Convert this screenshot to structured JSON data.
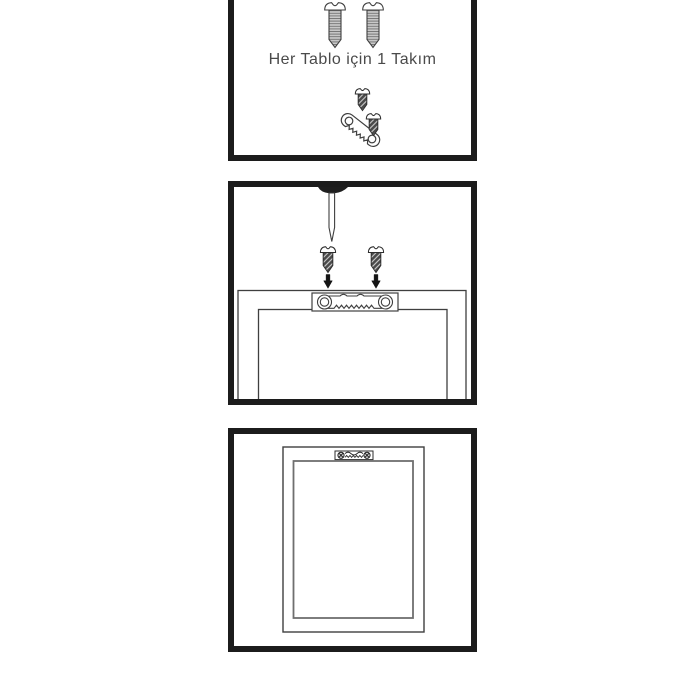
{
  "sheet": {
    "type": "picture-hanging-instruction-sheet",
    "language": "tr",
    "background": "#ffffff"
  },
  "colors": {
    "bg": "#ffffff",
    "panel_border": "#1c1c1c",
    "line": "#3f3f3f",
    "line_soft": "#6f6f6f",
    "screw_thread_fill": "#c9c9c9",
    "dark_screw_fill": "#4a4a4a",
    "arrow": "#141414",
    "text": "#4a4a4a"
  },
  "panels": [
    {
      "id": "kit",
      "caption": "Her Tablo için 1 Takım",
      "icons": [
        "screw-icon",
        "screw-icon",
        "small-screw-icon",
        "sawtooth-hanger-icon",
        "small-screw-icon"
      ]
    },
    {
      "id": "install",
      "caption": "",
      "icons": [
        "screwdriver-icon",
        "small-screw-icon",
        "small-screw-icon",
        "arrow-down-icon",
        "arrow-down-icon",
        "sawtooth-hanger-plate-icon",
        "frame-back-top-view"
      ]
    },
    {
      "id": "result",
      "caption": "",
      "icons": [
        "frame-back-view",
        "installed-sawtooth-hanger-icon"
      ]
    }
  ]
}
